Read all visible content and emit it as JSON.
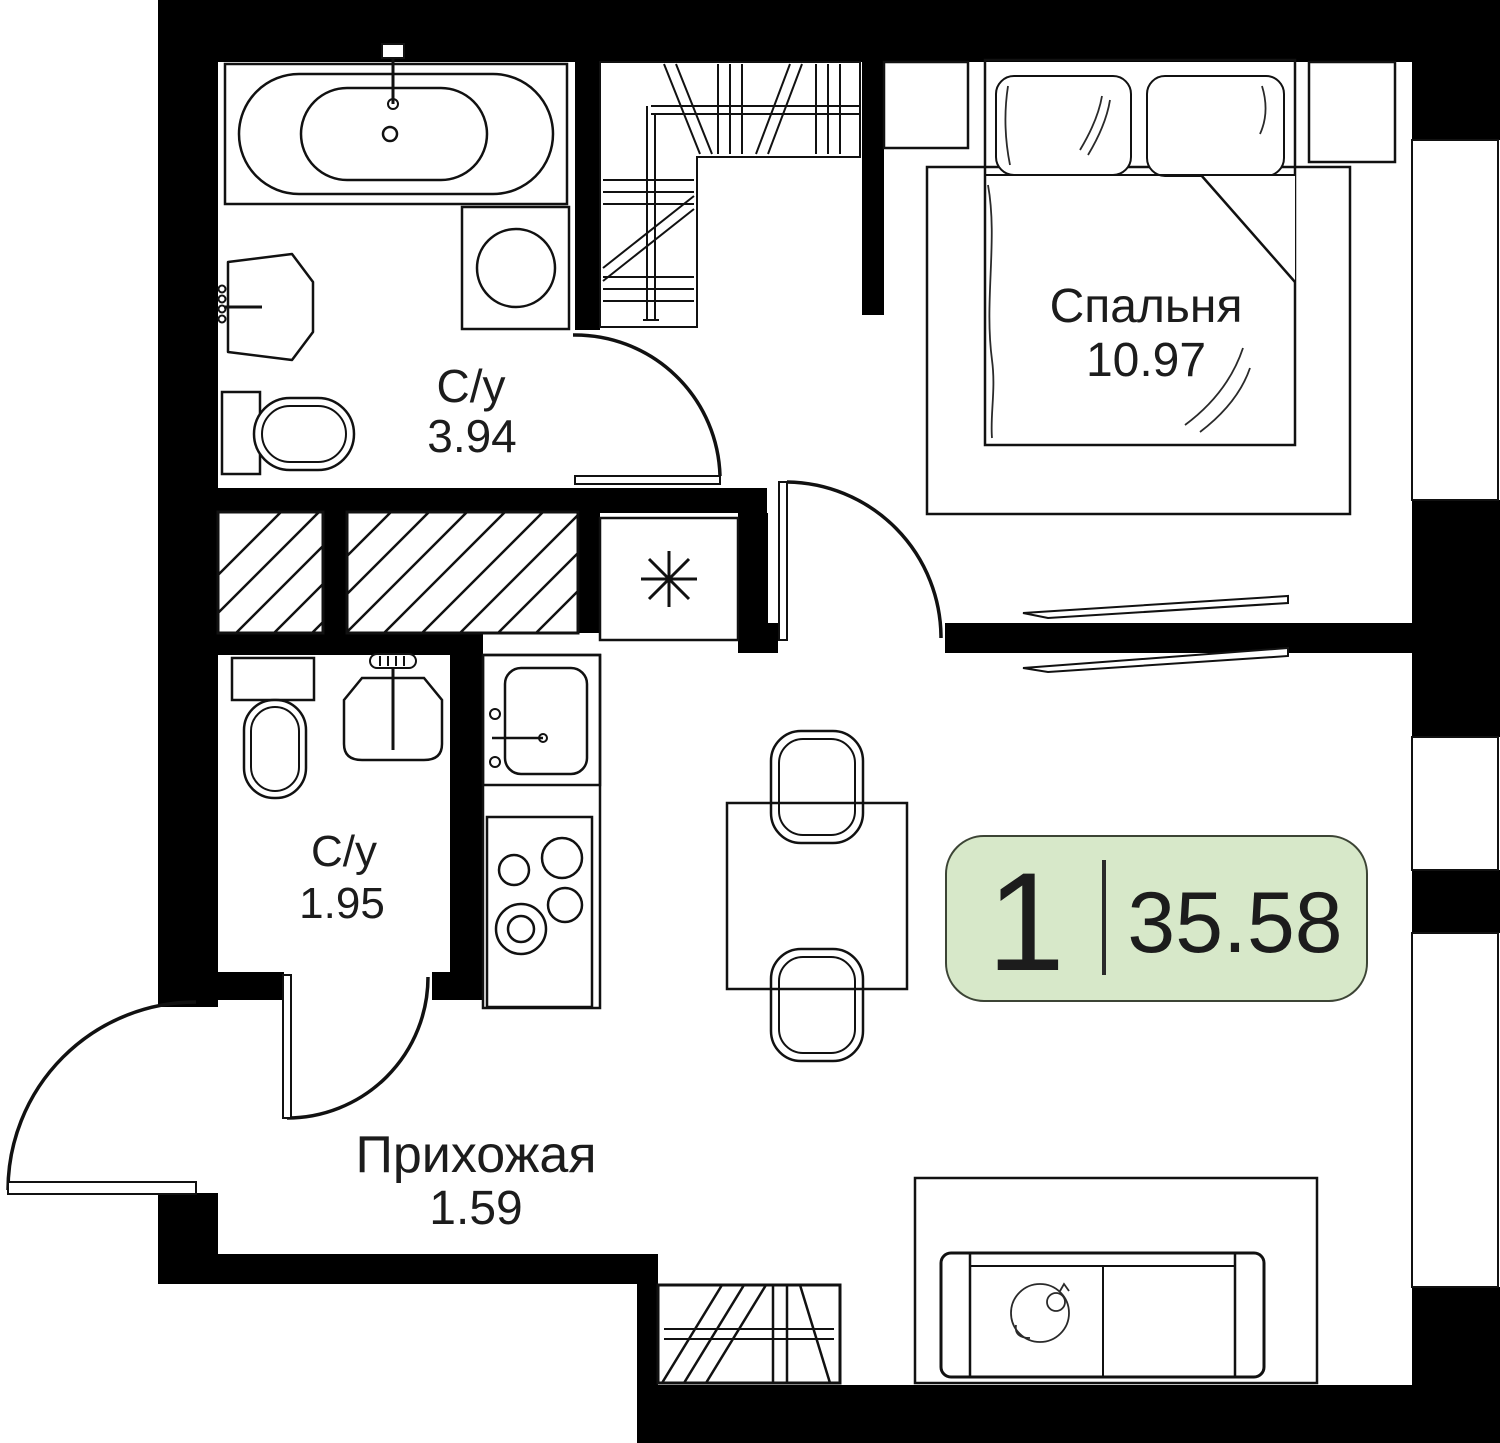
{
  "badge": {
    "room_count": "1",
    "area": "35.58"
  },
  "rooms": {
    "bedroom": {
      "label": "Спальня",
      "area": "10.97"
    },
    "bathroom_large": {
      "label": "С/у",
      "area": "3.94"
    },
    "bathroom_small": {
      "label": "С/у",
      "area": "1.95"
    },
    "hallway": {
      "label": "Прихожая",
      "area": "1.59"
    }
  },
  "colors": {
    "badge_fill": "#d7e8c9",
    "badge_border": "#3c4435",
    "rug": "#ececec",
    "wall": "#000000",
    "line": "#111111"
  }
}
